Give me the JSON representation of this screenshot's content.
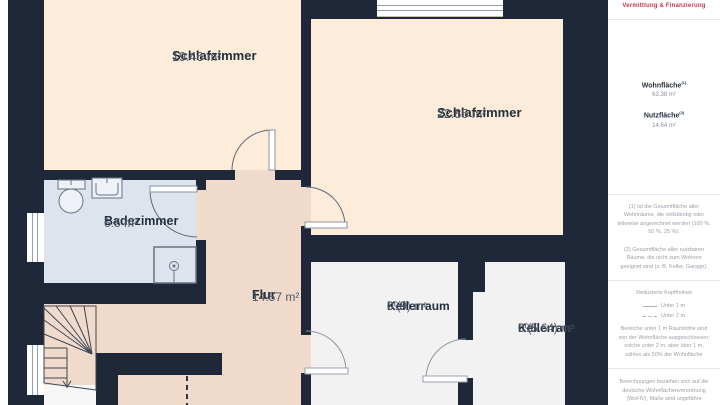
{
  "colors": {
    "wall": "#1e2838",
    "bedroom": "#fdecd9",
    "hallway": "#f0dacb",
    "bathroom": "#dee4ee",
    "cellar": "#f2f2f2",
    "accent_red": "#c2364e"
  },
  "floorplan": {
    "rooms": [
      {
        "id": "schlafzimmer-1",
        "name": "Schlafzimmer",
        "suffix": "",
        "area": "19.46 m²"
      },
      {
        "id": "schlafzimmer-2",
        "name": "Schlafzimmer",
        "suffix": "",
        "area": "22.85 m²"
      },
      {
        "id": "badezimmer",
        "name": "Badezimmer",
        "suffix": "",
        "area": "6.5 m²"
      },
      {
        "id": "flur",
        "name": "Flur",
        "suffix": "",
        "area": "14.57 m²"
      },
      {
        "id": "kellerraum-1",
        "name": "Kellerraum",
        "suffix": "0%",
        "area": "0 (9) m²"
      },
      {
        "id": "kellerraum-2",
        "name": "Kellerraum",
        "suffix": "0%",
        "area": "0 (5.64) m²"
      }
    ]
  },
  "sidebar": {
    "logo_line": "Vermittlung & Finanzierung",
    "metrics": [
      {
        "label": "Wohnfläche",
        "sup": "(1)",
        "value": "63.38 m²"
      },
      {
        "label": "Nutzfläche",
        "sup": "(2)",
        "value": "14.64 m²"
      }
    ],
    "footnote_1": "(1) Ist die Gesamtfläche aller Wohnräume, die vollständig oder teilweise angerechnet werden (100 %, 50 %, 25 %).",
    "footnote_2": "(2) Gesamtfläche aller nutzbaren Räume, die nicht zum Wohnen geeignet sind (z. B. Keller, Garage).",
    "legend_title": "Reduzierte Kopffreiheit",
    "legend_items": [
      {
        "style": "solid",
        "label": "Unter 1 m"
      },
      {
        "style": "dashed",
        "label": "Unter 2 m"
      }
    ],
    "legend_note": "Bereiche unter 1 m Raumhöhe sind von der Wohnfläche ausgeschlossen; solche unter 2 m, aber über 1 m, zählen als 50% der Wohnfläche",
    "disclaimer": "Berechnungen beziehen sich auf die deutsche Wohnflächenverordnung (WoFlV), Maße sind ungefähre Angaben"
  }
}
